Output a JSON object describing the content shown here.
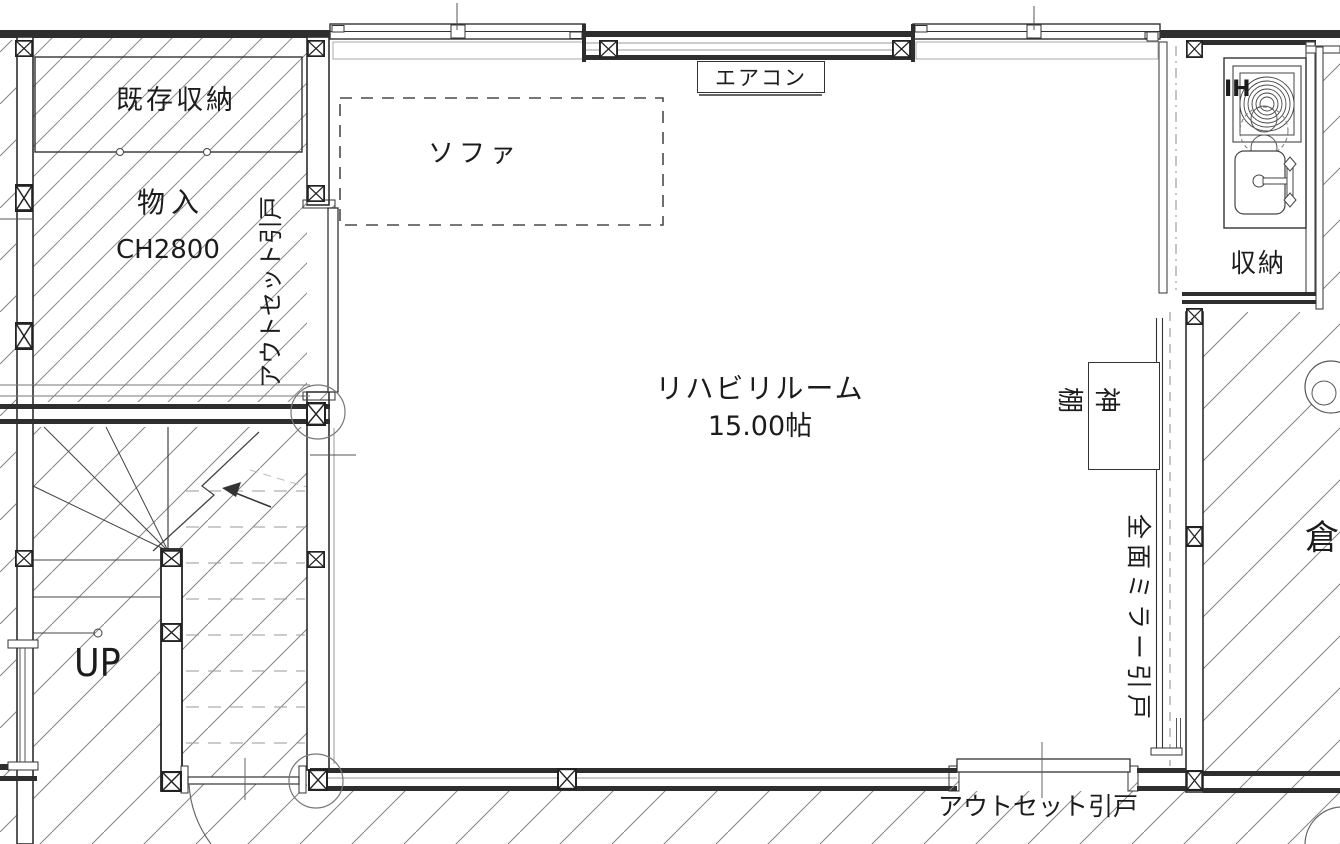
{
  "drawing": {
    "type": "architectural floor plan",
    "main_room": {
      "name": "リハビリルーム",
      "area": "15.00帖"
    }
  },
  "labels": {
    "existing_storage": "既存収納",
    "closet": "物入",
    "closet_ceiling_height": "CH2800",
    "outset_sliding_door_left": "アウトセット引戸",
    "sofa": "ソファ",
    "air_conditioner": "エアコン",
    "room_name": "リハビリルーム",
    "room_area": "15.00帖",
    "ih_cooktop": "IH",
    "storage": "収納",
    "kamidana": "神棚",
    "full_mirror_sliding_door": "全面ミラー引戸",
    "warehouse": "倉",
    "stairs_up": "UP",
    "outset_sliding_door_bottom": "アウトセット引戸"
  },
  "colors": {
    "line": "#2e2e2e",
    "hatch": "#8a8a8a",
    "background": "#ffffff"
  }
}
